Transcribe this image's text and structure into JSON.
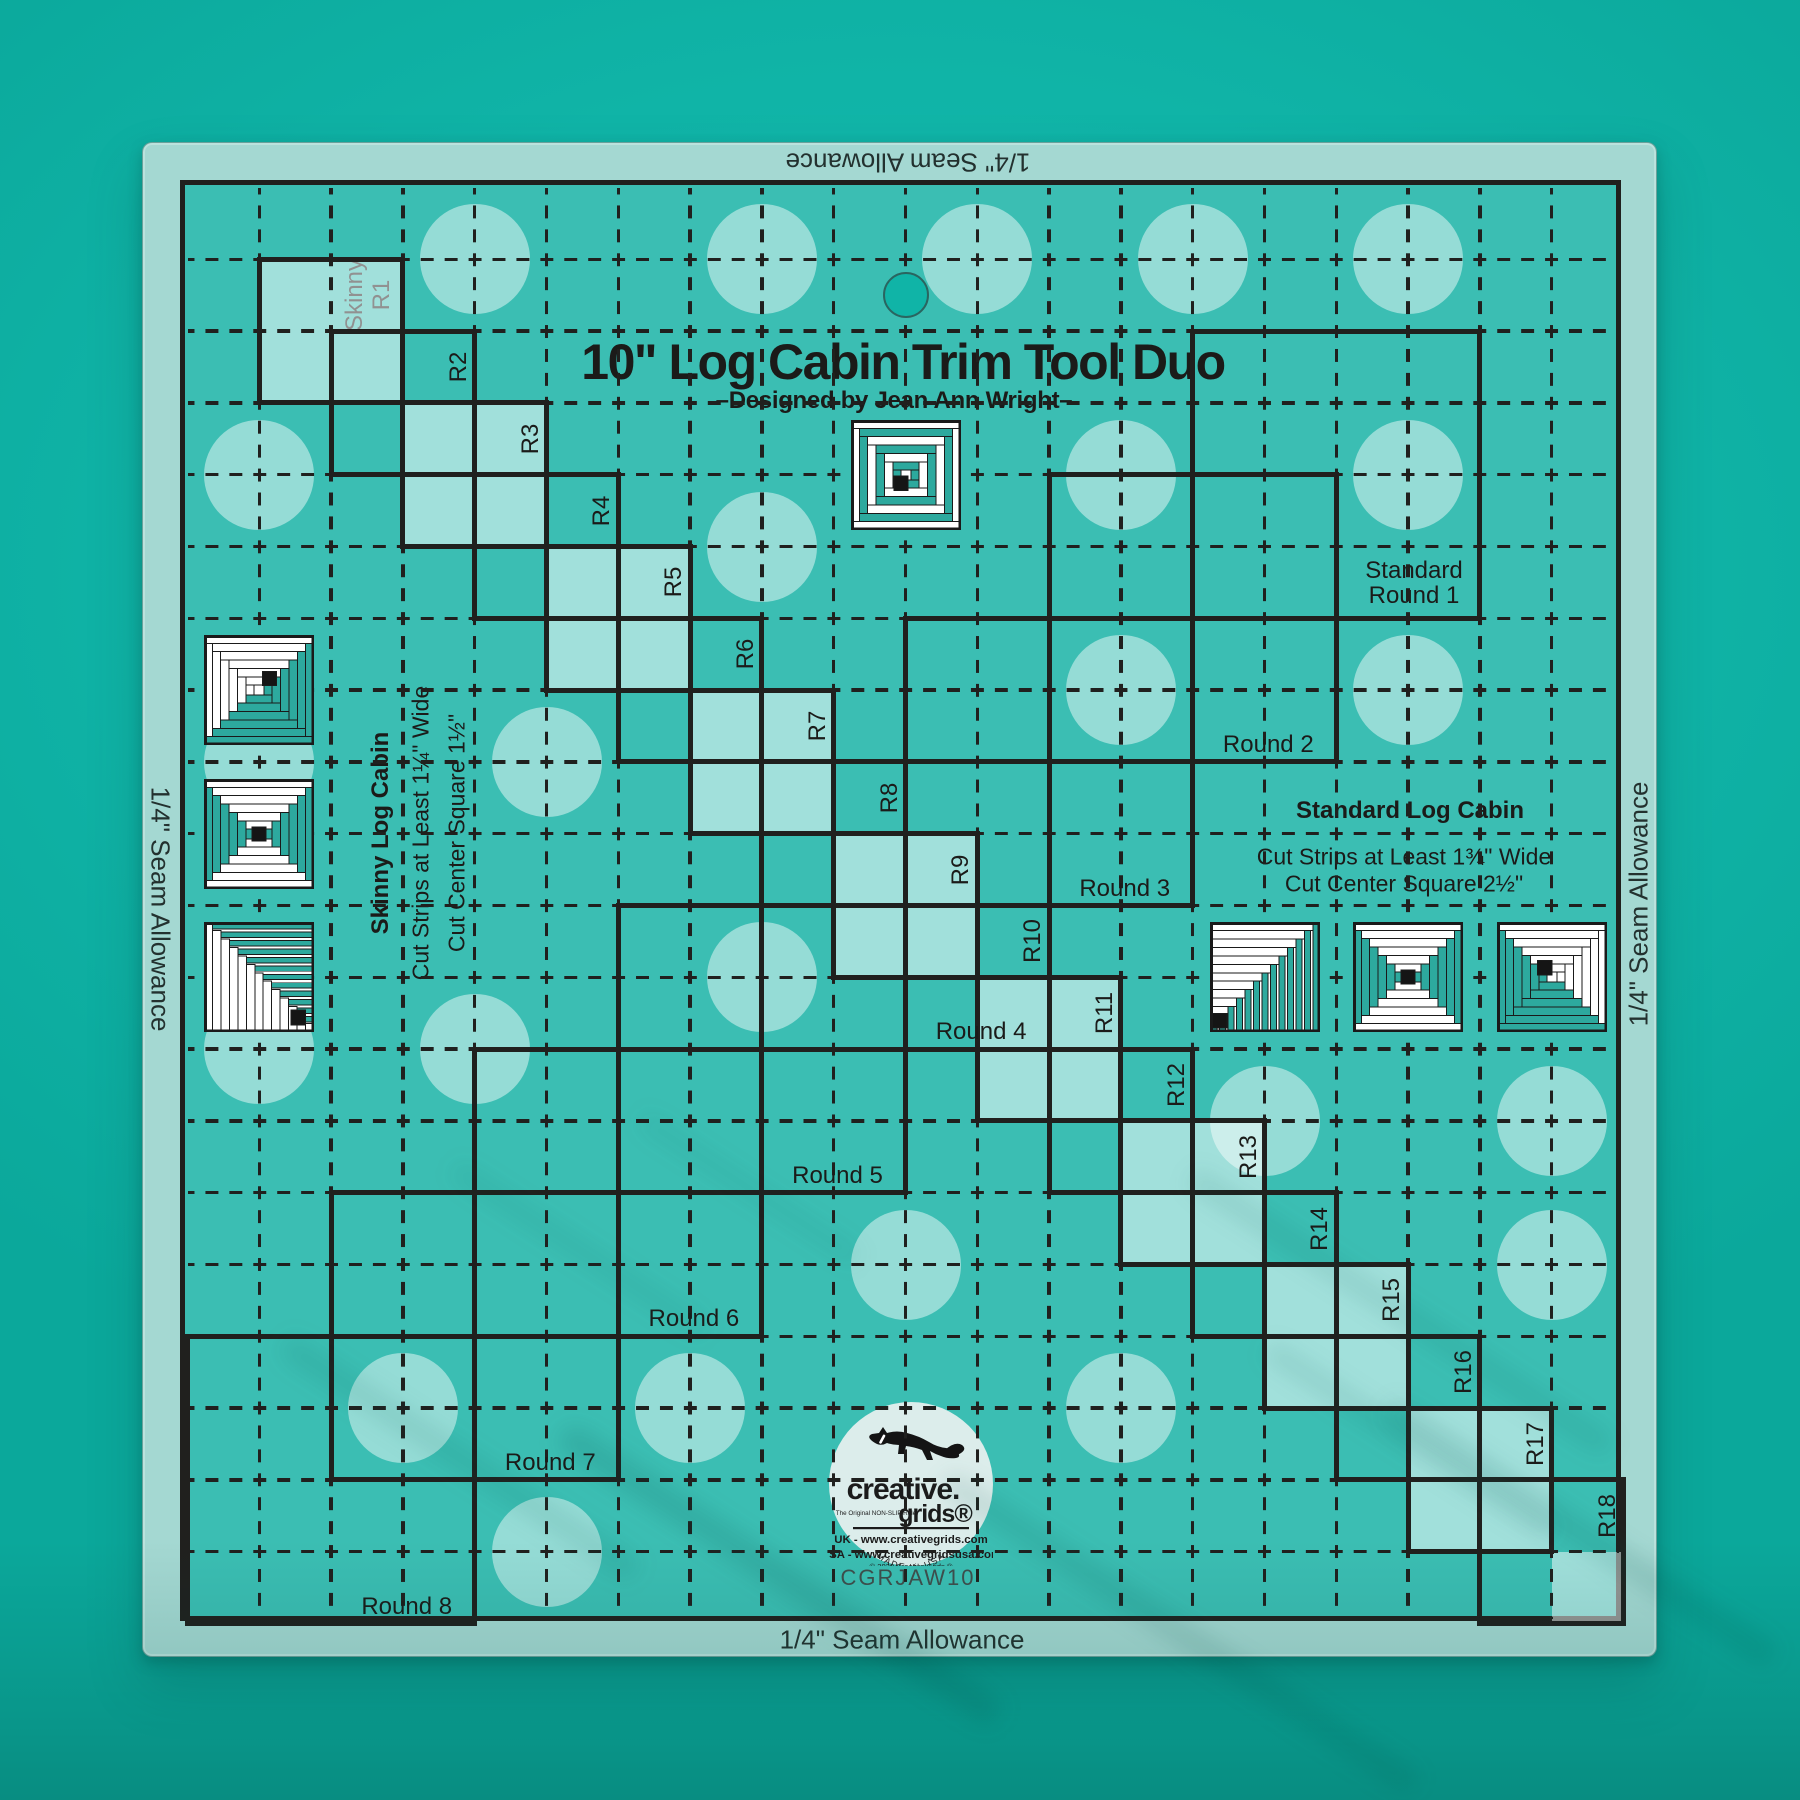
{
  "title": "10\" Log Cabin Trim Tool Duo",
  "subtitle": "–Designed by Jean Ann Wright–",
  "product_code": "CGRJAW10",
  "seam_allowance": {
    "top": "1/4\" Seam Allowance",
    "bottom": "1/4\" Seam Allowance",
    "left": "1/4\" Seam Allowance",
    "right": "1/4\" Seam Allowance"
  },
  "skinny_section": {
    "heading": "Skinny Log Cabin",
    "instruction1": "Cut Strips at Least 1¼\" Wide",
    "instruction2": "Cut Center Square 1½\"",
    "first_step_prefix": "Skinny",
    "steps": [
      "R1",
      "R2",
      "R3",
      "R4",
      "R5",
      "R6",
      "R7",
      "R8",
      "R9",
      "R10",
      "R11",
      "R12",
      "R13",
      "R14",
      "R15",
      "R16",
      "R17",
      "R18"
    ]
  },
  "standard_section": {
    "heading": "Standard Log Cabin",
    "instruction1": "Cut Strips at Least 1¾\" Wide",
    "instruction2": "Cut Center Square 2½\"",
    "round1_line1": "Standard",
    "round1_line2": "Round 1",
    "rounds": [
      "Round 2",
      "Round 3",
      "Round 4",
      "Round 5",
      "Round 6",
      "Round 7",
      "Round 8"
    ]
  },
  "logo": {
    "brand_top": "creative.",
    "brand_bottom": "grids®",
    "tagline": "The Original NON-SLIP Ruler",
    "uk_line": "UK - www.creativegrids.com",
    "usa_line": "USA - www.creativegridsusa.com",
    "copyright": "© 2020  Creative Grids ®",
    "made_in": "MADE IN USA"
  },
  "colors": {
    "background": "#10b4a7",
    "ruler_teal": "#3bbeb3",
    "frost_band": "#a4d8d2",
    "frost_cell": "rgba(255,255,255,0.52)",
    "frost_dot": "rgba(255,255,255,0.46)",
    "line_black": "#20201e",
    "block_teal": "#2da99e",
    "logo_bg": "#dcedeb"
  },
  "ruler_grid": {
    "unit_px": 71.8,
    "units_across": 20,
    "seam_margin_px": 37,
    "ruler_size_px": 1515,
    "ruler_offset_px": 142,
    "skinny_steps": 18,
    "standard_rounds": 8
  },
  "grip_dots": [
    [
      4,
      1
    ],
    [
      8,
      1
    ],
    [
      11,
      1
    ],
    [
      14,
      1
    ],
    [
      17,
      1
    ],
    [
      1,
      4
    ],
    [
      13,
      4
    ],
    [
      17,
      4
    ],
    [
      8,
      5
    ],
    [
      13,
      7
    ],
    [
      17,
      7
    ],
    [
      1,
      8
    ],
    [
      5,
      8
    ],
    [
      8,
      11
    ],
    [
      1,
      12
    ],
    [
      4,
      12
    ],
    [
      15,
      13
    ],
    [
      19,
      13
    ],
    [
      10,
      15
    ],
    [
      19,
      15
    ],
    [
      3,
      17
    ],
    [
      7,
      17
    ],
    [
      13,
      17
    ],
    [
      5,
      19
    ]
  ],
  "hanging_hole": {
    "gx": 10,
    "gy": 1.5
  },
  "blocks": [
    {
      "gx": 1,
      "gy": 7,
      "type": "log-cabin-white-top-left"
    },
    {
      "gx": 1,
      "gy": 9,
      "type": "courthouse-steps"
    },
    {
      "gx": 1,
      "gy": 11,
      "type": "diagonal-strips"
    },
    {
      "gx": 10,
      "gy": 4,
      "type": "concentric-rings"
    },
    {
      "gx": 15,
      "gy": 11,
      "type": "diagonal-strips-mirrored"
    },
    {
      "gx": 17,
      "gy": 11,
      "type": "courthouse-steps"
    },
    {
      "gx": 19,
      "gy": 11,
      "type": "log-cabin-teal-bottom-left"
    }
  ]
}
